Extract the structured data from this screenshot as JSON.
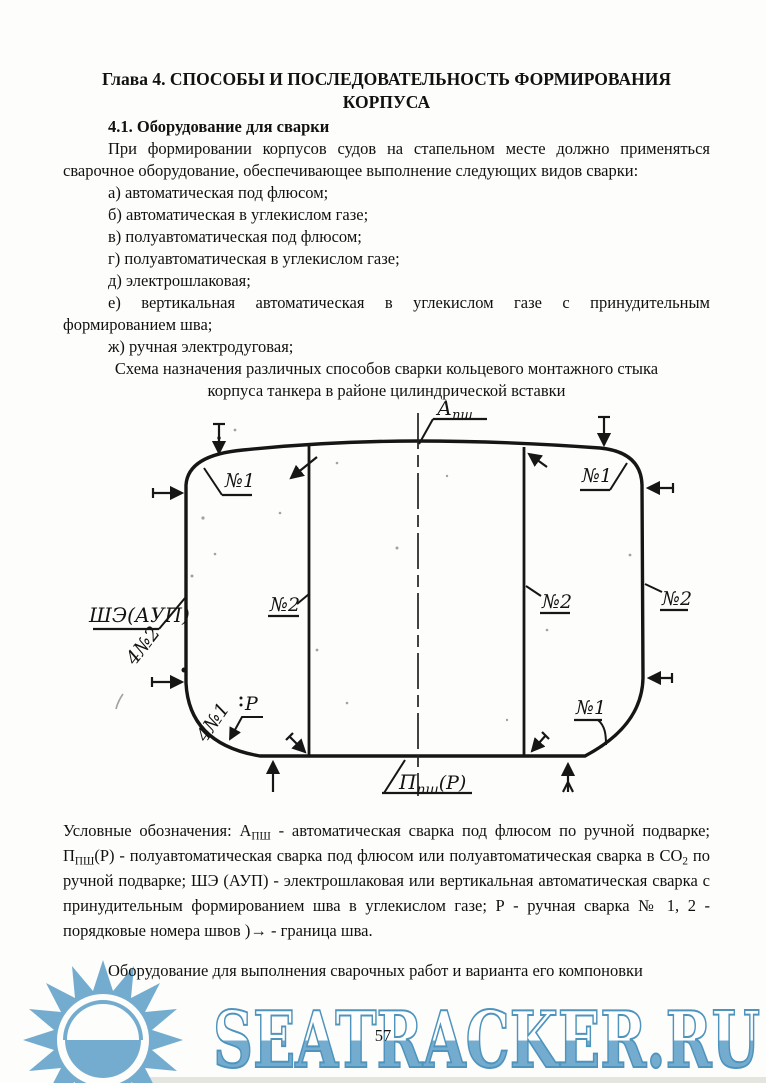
{
  "page": {
    "title_line1": "Глава 4. СПОСОБЫ И ПОСЛЕДОВАТЕЛЬНОСТЬ ФОРМИРОВАНИЯ",
    "title_line2": "КОРПУСА",
    "section_heading": "4.1. Оборудование для сварки",
    "intro": "При формировании корпусов судов на стапельном  месте должно применяться сварочное оборудование, обеспечивающее выполнение следующих видов сварки:",
    "list": [
      "а) автоматическая под флюсом;",
      "б) автоматическая в углекислом газе;",
      "в) полуавтоматическая под флюсом;",
      "г) полуавтоматическая в углекислом газе;",
      "д) электрошлаковая;",
      "е) вертикальная автоматическая в углекислом газе с принудительным формированием шва;",
      "ж) ручная электродуговая;"
    ],
    "caption": "Схема назначения различных способов сварки кольцевого монтажного стыка корпуса танкера в районе цилиндрической вставки",
    "legend": {
      "p1": "Условные обозначения:  А",
      "s1": "ПШ",
      "p2": " - автоматическая сварка под флюсом по ручной подварке; П",
      "s2": "ПШ",
      "p3": "(Р) - полуавтоматическая сварка под флюсом или полуавтоматическая сварка в СО",
      "s3": "2",
      "p4": " по ручной подварке; ШЭ (АУП) - электрошлаковая или вертикальная автоматическая сварка с принудительным формированием шва в углекислом газе; Р - ручная сварка № 1, 2 - порядковые номера швов )→ - граница шва.",
      "number": "57"
    },
    "closing": "Оборудование для выполнения сварочных работ и варианта его компоновки",
    "number": "57"
  },
  "diagram": {
    "label_a_psh": {
      "main": "А",
      "sub": "пш"
    },
    "label_p_psh": {
      "main": "П",
      "sub": "пш",
      "suffix": "(Р)"
    },
    "label_she_aup": "ШЭ(АУП)",
    "label_n1": "№1",
    "label_n2": "№2",
    "label_4n2": "4№2",
    "label_4n1": "4№1",
    "label_r": "Р"
  },
  "watermark": {
    "text": "SEATRACKER.RU",
    "color": "#74accf",
    "stroke": "#4f94bd",
    "fill_top": "#ffffff"
  }
}
